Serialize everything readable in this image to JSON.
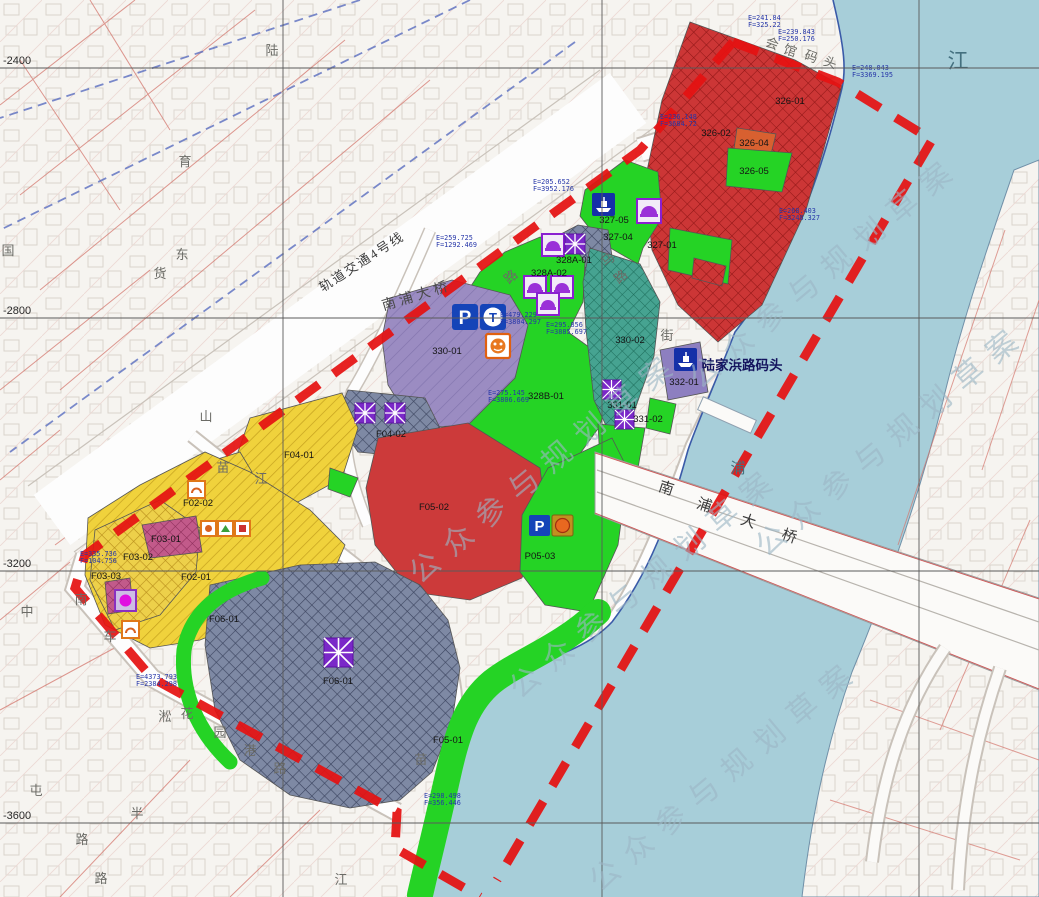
{
  "watermark": {
    "text": "公众参与规划草案"
  },
  "colors": {
    "water": "#a7ced9",
    "boundary_red": "#e51212",
    "parcel_red": "#cc3636",
    "parcel_green": "#25d325",
    "parcel_yellow": "#f0d23c",
    "parcel_slate": "#7e89a4",
    "parcel_teal": "#46a391",
    "parcel_pink": "#c25a8a",
    "parcel_purple": "#9b8cc2",
    "icon_blue": "#1544b8",
    "icon_orange": "#e07818",
    "icon_purple": "#8a1fd0"
  },
  "parcels": [
    {
      "label": "326-01"
    },
    {
      "label": "326-02"
    },
    {
      "label": "326-04"
    },
    {
      "label": "326-05"
    },
    {
      "label": "327-01"
    },
    {
      "label": "327-04"
    },
    {
      "label": "327-05"
    },
    {
      "label": "328A-01"
    },
    {
      "label": "328A-02"
    },
    {
      "label": "328B-01"
    },
    {
      "label": "330-01"
    },
    {
      "label": "330-02"
    },
    {
      "label": "331-01"
    },
    {
      "label": "331-02"
    },
    {
      "label": "332-01"
    },
    {
      "label": "F04-01"
    },
    {
      "label": "F04-02"
    },
    {
      "label": "F02-01"
    },
    {
      "label": "F02-02"
    },
    {
      "label": "F03-01"
    },
    {
      "label": "F03-02"
    },
    {
      "label": "F03-03"
    },
    {
      "label": "F05-02"
    },
    {
      "label": "P05-03"
    },
    {
      "label": "F05-01"
    },
    {
      "label": "F06-01"
    }
  ],
  "pois": {
    "ferry_terminal": "陆家浜路码头",
    "bridge_chars": [
      "南",
      "浦",
      "大",
      "桥"
    ],
    "viaduct_label": "南浦大桥",
    "metro_label": "轨道交通4号线"
  },
  "river": {
    "char_top": "江",
    "char_mid": "浦"
  },
  "streets": [
    {
      "c": "陆"
    },
    {
      "c": "国"
    },
    {
      "c": "货"
    },
    {
      "c": "育"
    },
    {
      "c": "东"
    },
    {
      "c": "山"
    },
    {
      "c": "路"
    },
    {
      "c": "街"
    },
    {
      "c": "马"
    },
    {
      "c": "路"
    },
    {
      "c": "苗"
    },
    {
      "c": "江"
    },
    {
      "c": "苗"
    },
    {
      "c": "江"
    },
    {
      "c": "花"
    },
    {
      "c": "园"
    },
    {
      "c": "港"
    },
    {
      "c": "路"
    },
    {
      "c": "淞"
    },
    {
      "c": "半"
    },
    {
      "c": "路"
    },
    {
      "c": "路"
    },
    {
      "c": "中"
    },
    {
      "c": "南"
    },
    {
      "c": "车"
    },
    {
      "c": "屯"
    },
    {
      "c": "会"
    },
    {
      "c": "馆"
    },
    {
      "c": "码"
    },
    {
      "c": "头"
    }
  ],
  "grid": {
    "y_labels": [
      "-2400",
      "-2800",
      "-3200",
      "-3600"
    ]
  },
  "coord_labels": [
    {
      "e": "E=241.84",
      "f": "F=325.22"
    },
    {
      "e": "E=239.843",
      "f": "F=250.176"
    },
    {
      "e": "E=248.043",
      "f": "F=3369.195"
    },
    {
      "e": "E=236.148",
      "f": "F=3684.72"
    },
    {
      "e": "E=268.403",
      "f": "F=3248.327"
    },
    {
      "e": "E=259.725",
      "f": "F=1292.469"
    },
    {
      "e": "E=205.652",
      "f": "F=3952.176"
    },
    {
      "e": "E=479.229",
      "f": "F=3804.297"
    },
    {
      "e": "E=295.856",
      "f": "F=3885.697"
    },
    {
      "e": "E=275.145",
      "f": "F=3806.669"
    },
    {
      "e": "E=335.736",
      "f": "F=104.756"
    },
    {
      "e": "E=4373.793",
      "f": "F=2384.298"
    },
    {
      "e": "E=298.498",
      "f": "F=356.446"
    }
  ],
  "icons": {
    "parking": "P",
    "transit": "T"
  }
}
